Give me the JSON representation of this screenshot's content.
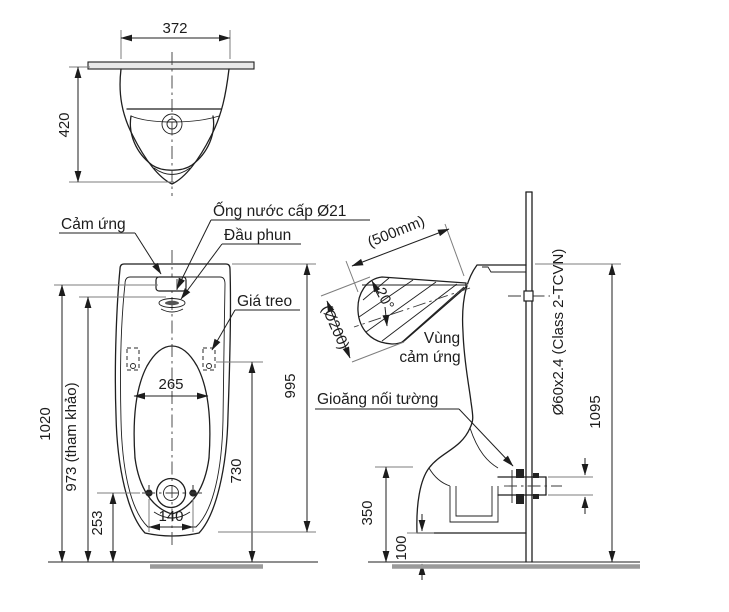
{
  "colors": {
    "background": "#ffffff",
    "line": "#1f1f1f",
    "extension_gray": "#7d7d7d",
    "floor_gray": "#9a9a9a"
  },
  "top_view": {
    "dims": {
      "width": "372",
      "depth": "420"
    }
  },
  "front_view": {
    "labels": {
      "sensor": "Cảm ứng",
      "supply_pipe": "Ống nước cấp Ø21",
      "spray_head": "Đầu phun",
      "hanger": "Giá treo"
    },
    "dims": {
      "sensor_height": "1020",
      "reference_height": "973 (tham khảo)",
      "opening_width": "265",
      "drain_height": "253",
      "bolt_pitch": "140",
      "rim_height": "730",
      "body_height": "995"
    }
  },
  "side_view": {
    "labels": {
      "sensing_zone_line1": "Vùng",
      "sensing_zone_line2": "cảm ứng",
      "wall_gasket": "Gioăng nối tường"
    },
    "dims": {
      "sensing_distance": "(500mm)",
      "sensing_angle": "20°",
      "sensing_diameter": "(Ø200)",
      "drain_pipe_spec": "Ø60x2.4 (Class 2-TCVN)",
      "overall_height": "1095",
      "outlet_height": "350",
      "base_clearance": "100"
    }
  }
}
